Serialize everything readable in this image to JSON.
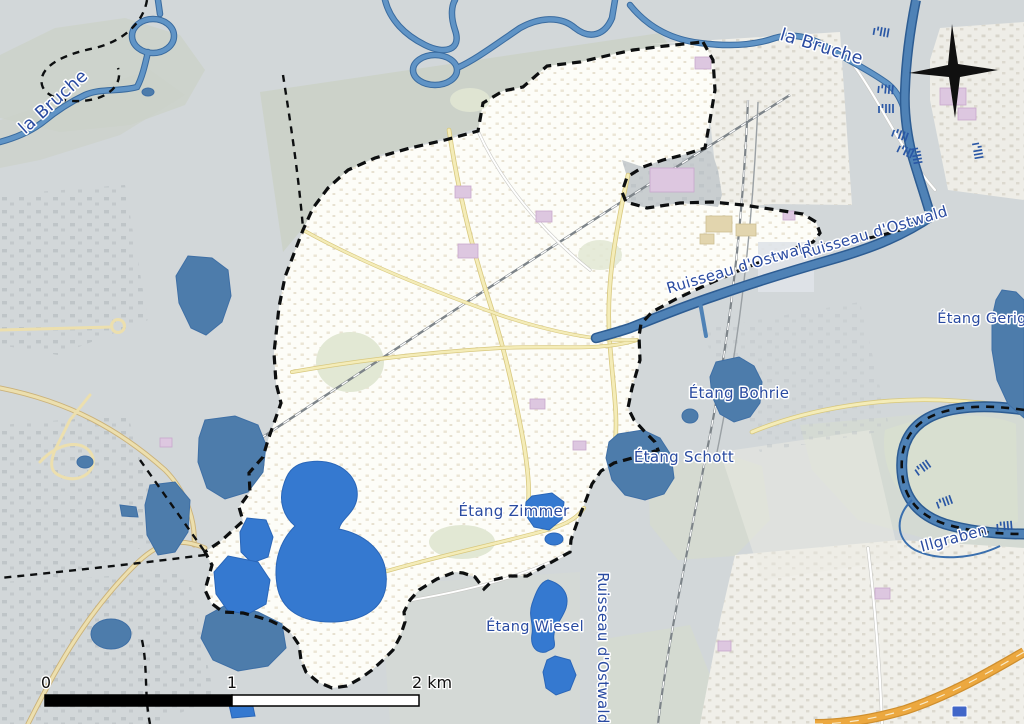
{
  "map_labels": {
    "la_bruche_nw": "la Bruche",
    "la_bruche_ne": "la Bruche",
    "ruisseau_dostwald_west": "Ruisseau d'Ostwald",
    "ruisseau_dostwald_east": "Ruisseau d'Ostwald",
    "ruisseau_dostwald_south": "Ruisseau d'Ostwald",
    "etang_gerig": "Étang Gerig",
    "etang_bohrie": "Étang Bohrie",
    "etang_schott": "Étang Schott",
    "etang_zimmer": "Étang Zimmer",
    "etang_wiesel": "Étang Wiesel",
    "illgraben": "Illgraben"
  },
  "scale_bar": {
    "label_0": "0",
    "label_1": "1",
    "label_2": "2 km"
  },
  "colors": {
    "land_gray": "#d2d7d9",
    "woodland": "#cbd1c6",
    "pale_green": "#d8dfd0",
    "urban_light": "#f0efe9",
    "commune_fill": "#fdfdf8",
    "water_bright": "#3579d0",
    "water_muted": "#4d7cab",
    "river_stroke": "#6094c6",
    "canal_stroke": "#4f82b6",
    "boundary_black": "#0d0f10",
    "label_blue": "#2a4ba1",
    "motorway_orange": "#eca83f",
    "accent_purple": "#ddc7e0",
    "road_yellow": "#f4ecb8"
  }
}
